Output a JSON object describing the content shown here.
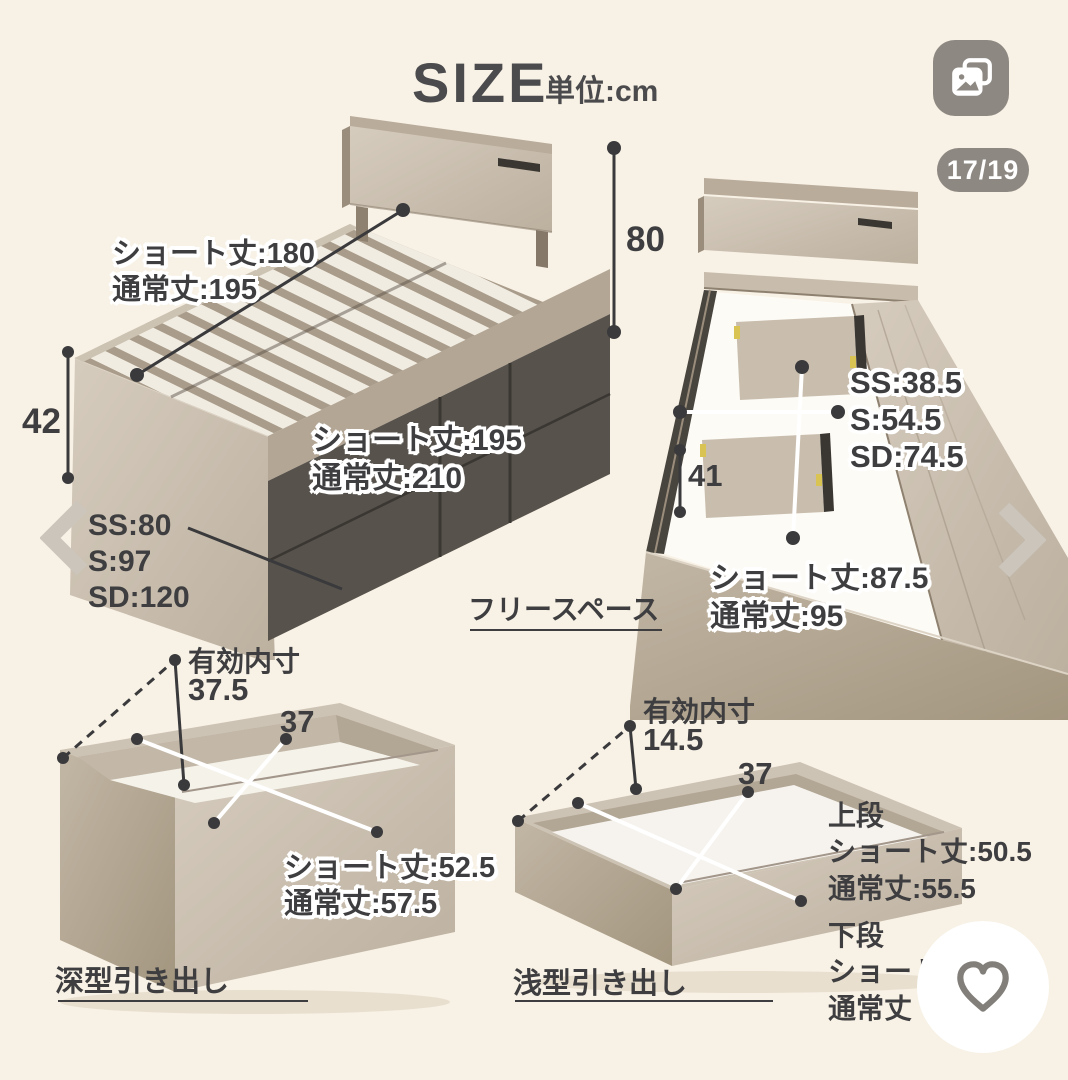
{
  "header": {
    "title": "SIZE",
    "unit": "単位:cm"
  },
  "viewer": {
    "counter": "17/19",
    "gallery_icon": "photo-stack-icon",
    "prev_icon": "chevron-left-icon",
    "next_icon": "chevron-right-icon",
    "favorite_icon": "heart-icon"
  },
  "bed_overview": {
    "slat_length": [
      "ショート丈:180",
      "通常丈:195"
    ],
    "headboard_height": "80",
    "frame_height": "42",
    "widths": [
      "SS:80",
      "S:97",
      "SD:120"
    ],
    "total_length": [
      "ショート丈:195",
      "通常丈:210"
    ]
  },
  "bed_frame": {
    "inner_widths": [
      "SS:38.5",
      "S:54.5",
      "SD:74.5"
    ],
    "inner_depth": "41",
    "free_space_length": [
      "ショート丈:87.5",
      "通常丈:95"
    ],
    "free_space": "フリースペース"
  },
  "deep_drawer": {
    "inner_label": "有効内寸",
    "inner_height": "37.5",
    "inner_width": "37",
    "length": [
      "ショート丈:52.5",
      "通常丈:57.5"
    ],
    "caption": "深型引き出し"
  },
  "shallow_drawer": {
    "inner_label": "有効内寸",
    "inner_height": "14.5",
    "inner_width": "37",
    "upper_title": "上段",
    "upper_length": [
      "ショート丈:50.5",
      "通常丈:55.5"
    ],
    "lower_title": "下段",
    "lower_length": [
      "ショート",
      "通常丈"
    ],
    "caption": "浅型引き出し"
  },
  "colors": {
    "background": "#f8f1e5",
    "title": "#4b4b4d",
    "label": "#3e3e40",
    "control_gray": "#8d8882",
    "chevron_gray": "#cbc5bc",
    "wood_light": "#d2c8ba",
    "wood_mid": "#b3a695",
    "drawer_front_dark": "#57524c",
    "slat_white": "#f1ece2",
    "dimension_line": "#3a3a3c",
    "heart_gray": "#827e79",
    "hinge_yellow": "#d9c352"
  }
}
